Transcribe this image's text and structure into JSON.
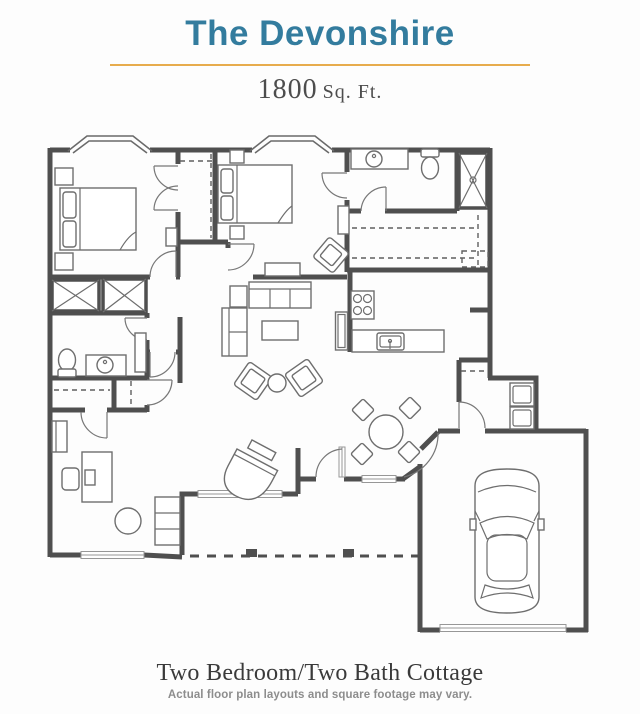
{
  "header": {
    "title": "The Devonshire",
    "sqft_value": "1800",
    "sqft_unit": "Sq. Ft."
  },
  "footer": {
    "title": "Two Bedroom/Two Bath Cottage",
    "disclaimer": "Actual floor plan layouts and square footage may vary."
  },
  "colors": {
    "accent_teal": "#337C9E",
    "accent_gold": "#E7AC4D",
    "wall_gray": "#4f4f4f",
    "furniture_gray": "#6e6e6e"
  },
  "floorplan": {
    "type": "residential-cottage",
    "rooms": [
      "bedroom-1",
      "master-bedroom",
      "master-bathroom",
      "walk-in-closet",
      "hall-bathroom",
      "kitchen",
      "living-room",
      "dining-nook",
      "den-office",
      "laundry-mudroom",
      "garage",
      "front-porch"
    ],
    "drawn_items": [
      "two bay windows",
      "two beds with nightstands",
      "wardrobe closets with X symbols",
      "tiled shower with X symbol",
      "two toilets",
      "two vanity sinks",
      "sofa, loveseat, coffee table, two armchairs with round side table",
      "grand piano with bench",
      "round dining table with four chairs",
      "kitchen stove, sink, dishwasher, refrigerator",
      "stacked washer and dryer",
      "desk with chair, bookshelf, round table",
      "car in garage",
      "dashed patio line with posts",
      "garage door"
    ]
  }
}
